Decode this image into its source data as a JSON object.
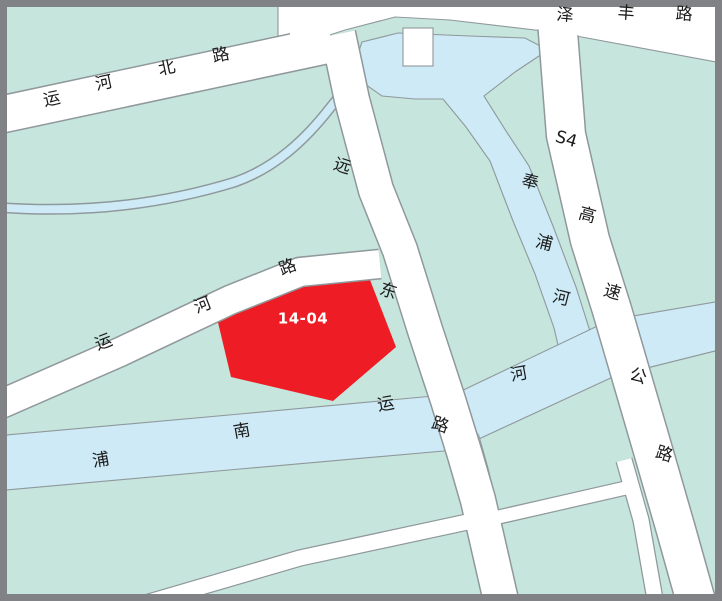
{
  "colors": {
    "land": "#c6e5dd",
    "water": "#cdeaf6",
    "road": "#ffffff",
    "casing": "#8f989b",
    "parcel": "#ee1c24",
    "frame": "#808285",
    "label": "#1b1b1b",
    "parcel_label": "#ffffff"
  },
  "parcel": {
    "id": "14-04"
  },
  "roads": [
    {
      "id": "yunhe-north-road",
      "name": "运河北路"
    },
    {
      "id": "zefeng-road",
      "name": "泽丰路"
    },
    {
      "id": "yuandong-road",
      "name": "远东路"
    },
    {
      "id": "s4-expressway",
      "name": "S4高速公路"
    },
    {
      "id": "yunhe-road",
      "name": "运河路"
    }
  ],
  "waterways": [
    {
      "id": "fengpu-river",
      "name": "奉浦河"
    },
    {
      "id": "punan-canal",
      "name": "浦南运河"
    }
  ],
  "labels": [
    {
      "name": "road-label-yunhebei-1",
      "text": "运",
      "x": 52,
      "y": 100,
      "rot": -12,
      "cls": "road"
    },
    {
      "name": "road-label-yunhebei-2",
      "text": "河",
      "x": 104,
      "y": 84,
      "rot": -12,
      "cls": "road"
    },
    {
      "name": "road-label-yunhebei-3",
      "text": "北",
      "x": 167,
      "y": 69,
      "rot": -12,
      "cls": "road"
    },
    {
      "name": "road-label-yunhebei-4",
      "text": "路",
      "x": 221,
      "y": 56,
      "rot": -12,
      "cls": "road"
    },
    {
      "name": "road-label-zefeng-1",
      "text": "泽",
      "x": 565,
      "y": 16,
      "rot": 5,
      "cls": "road"
    },
    {
      "name": "road-label-zefeng-2",
      "text": "丰",
      "x": 626,
      "y": 14,
      "rot": 4,
      "cls": "road"
    },
    {
      "name": "road-label-zefeng-3",
      "text": "路",
      "x": 684,
      "y": 15,
      "rot": 4,
      "cls": "road"
    },
    {
      "name": "road-label-yuandong-1",
      "text": "远",
      "x": 342,
      "y": 167,
      "rot": 18,
      "cls": "road"
    },
    {
      "name": "road-label-yuandong-2",
      "text": "东",
      "x": 388,
      "y": 292,
      "rot": 18,
      "cls": "road"
    },
    {
      "name": "road-label-yuandong-3",
      "text": "路",
      "x": 440,
      "y": 426,
      "rot": 18,
      "cls": "road"
    },
    {
      "name": "road-label-s4",
      "text": "S4",
      "x": 566,
      "y": 140,
      "rot": 16,
      "cls": "road"
    },
    {
      "name": "road-label-s4-gao",
      "text": "高",
      "x": 587,
      "y": 216,
      "rot": 16,
      "cls": "road"
    },
    {
      "name": "road-label-s4-su",
      "text": "速",
      "x": 612,
      "y": 293,
      "rot": 16,
      "cls": "road"
    },
    {
      "name": "road-label-s4-gong",
      "text": "公",
      "x": 638,
      "y": 377,
      "rot": 17,
      "cls": "road"
    },
    {
      "name": "road-label-s4-lu",
      "text": "路",
      "x": 664,
      "y": 455,
      "rot": 17,
      "cls": "road"
    },
    {
      "name": "water-label-fengpu-1",
      "text": "奉",
      "x": 530,
      "y": 183,
      "rot": 14,
      "cls": "road"
    },
    {
      "name": "water-label-fengpu-2",
      "text": "浦",
      "x": 544,
      "y": 244,
      "rot": 14,
      "cls": "road"
    },
    {
      "name": "water-label-fengpu-3",
      "text": "河",
      "x": 561,
      "y": 299,
      "rot": 14,
      "cls": "road"
    },
    {
      "name": "road-label-yunhe-1",
      "text": "运",
      "x": 104,
      "y": 343,
      "rot": -21,
      "cls": "road"
    },
    {
      "name": "road-label-yunhe-2",
      "text": "河",
      "x": 203,
      "y": 306,
      "rot": -21,
      "cls": "road"
    },
    {
      "name": "road-label-yunhe-3",
      "text": "路",
      "x": 288,
      "y": 268,
      "rot": -21,
      "cls": "road"
    },
    {
      "name": "water-label-punan-1",
      "text": "浦",
      "x": 101,
      "y": 461,
      "rot": -10,
      "cls": "road"
    },
    {
      "name": "water-label-punan-2",
      "text": "南",
      "x": 242,
      "y": 432,
      "rot": -10,
      "cls": "road"
    },
    {
      "name": "water-label-punan-3",
      "text": "运",
      "x": 386,
      "y": 405,
      "rot": -10,
      "cls": "road"
    },
    {
      "name": "water-label-punan-4",
      "text": "河",
      "x": 519,
      "y": 375,
      "rot": -10,
      "cls": "road"
    },
    {
      "name": "parcel-label-14-04",
      "text": "14-04",
      "x": 303,
      "y": 319,
      "rot": 0,
      "cls": "parcel"
    }
  ]
}
